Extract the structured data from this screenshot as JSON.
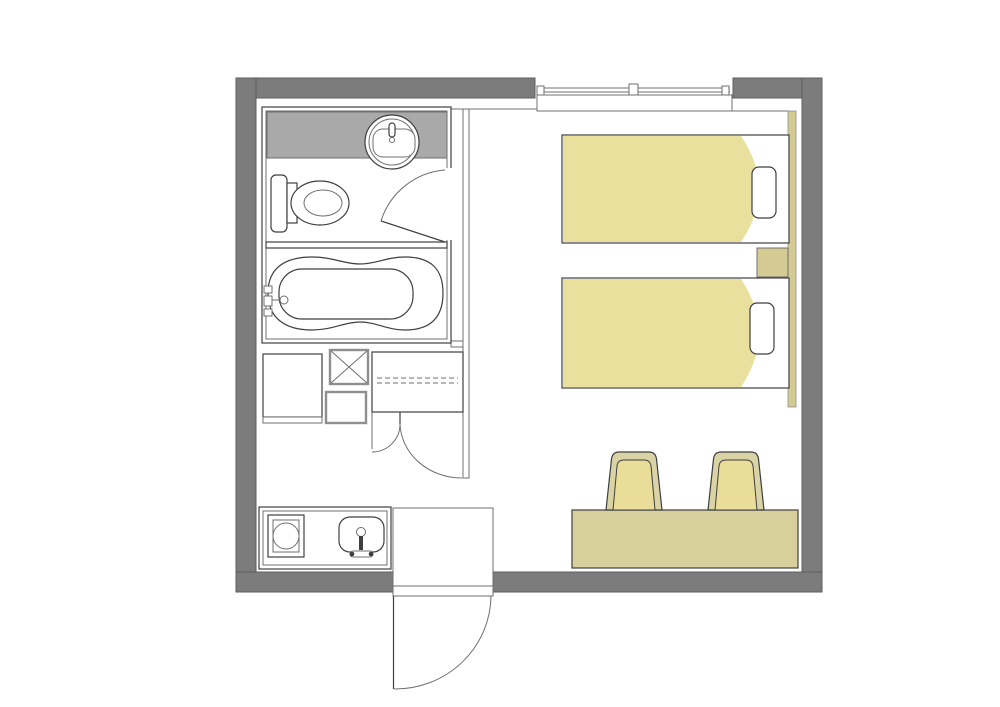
{
  "document": {
    "title": "Hotel room floor plan",
    "type": "architectural-floor-plan",
    "has_text_labels": false
  },
  "colors": {
    "background": "#ffffff",
    "wall": "#7c7c7c",
    "wall_outline": "#5e5e5e",
    "line": "#3f3f3f",
    "line_mid": "#6f6f6f",
    "line_gray": "#8f8f8f",
    "vanity_counter": "#a9a9a9",
    "bed_spread": "#eae09e",
    "furniture_tan": "#d7d09c",
    "headboard_tan": "#d4cb93",
    "chair_seat": "#e9dd99",
    "chair_frame": "#dad3a6",
    "fixture_fill": "#ffffff"
  },
  "inventory": {
    "rooms": [
      "bathroom-vanity-toilet-room",
      "bath-tub-room",
      "bedroom",
      "kitchenette",
      "entry-hall"
    ],
    "fixtures": [
      "window",
      "washbasin",
      "toilet",
      "bathtub",
      "refrigerator",
      "pipe-shaft",
      "storage-cabinet",
      "closet-with-shelf",
      "stove",
      "kitchen-sink",
      "entry-vestibule",
      "twin-bed",
      "twin-bed",
      "pillow",
      "pillow",
      "nightstand",
      "headboard-panel",
      "desk",
      "chair",
      "chair"
    ],
    "counts": {
      "beds": 2,
      "chairs": 2,
      "pillows": 2,
      "door_swings": 4,
      "windows": 1
    }
  }
}
